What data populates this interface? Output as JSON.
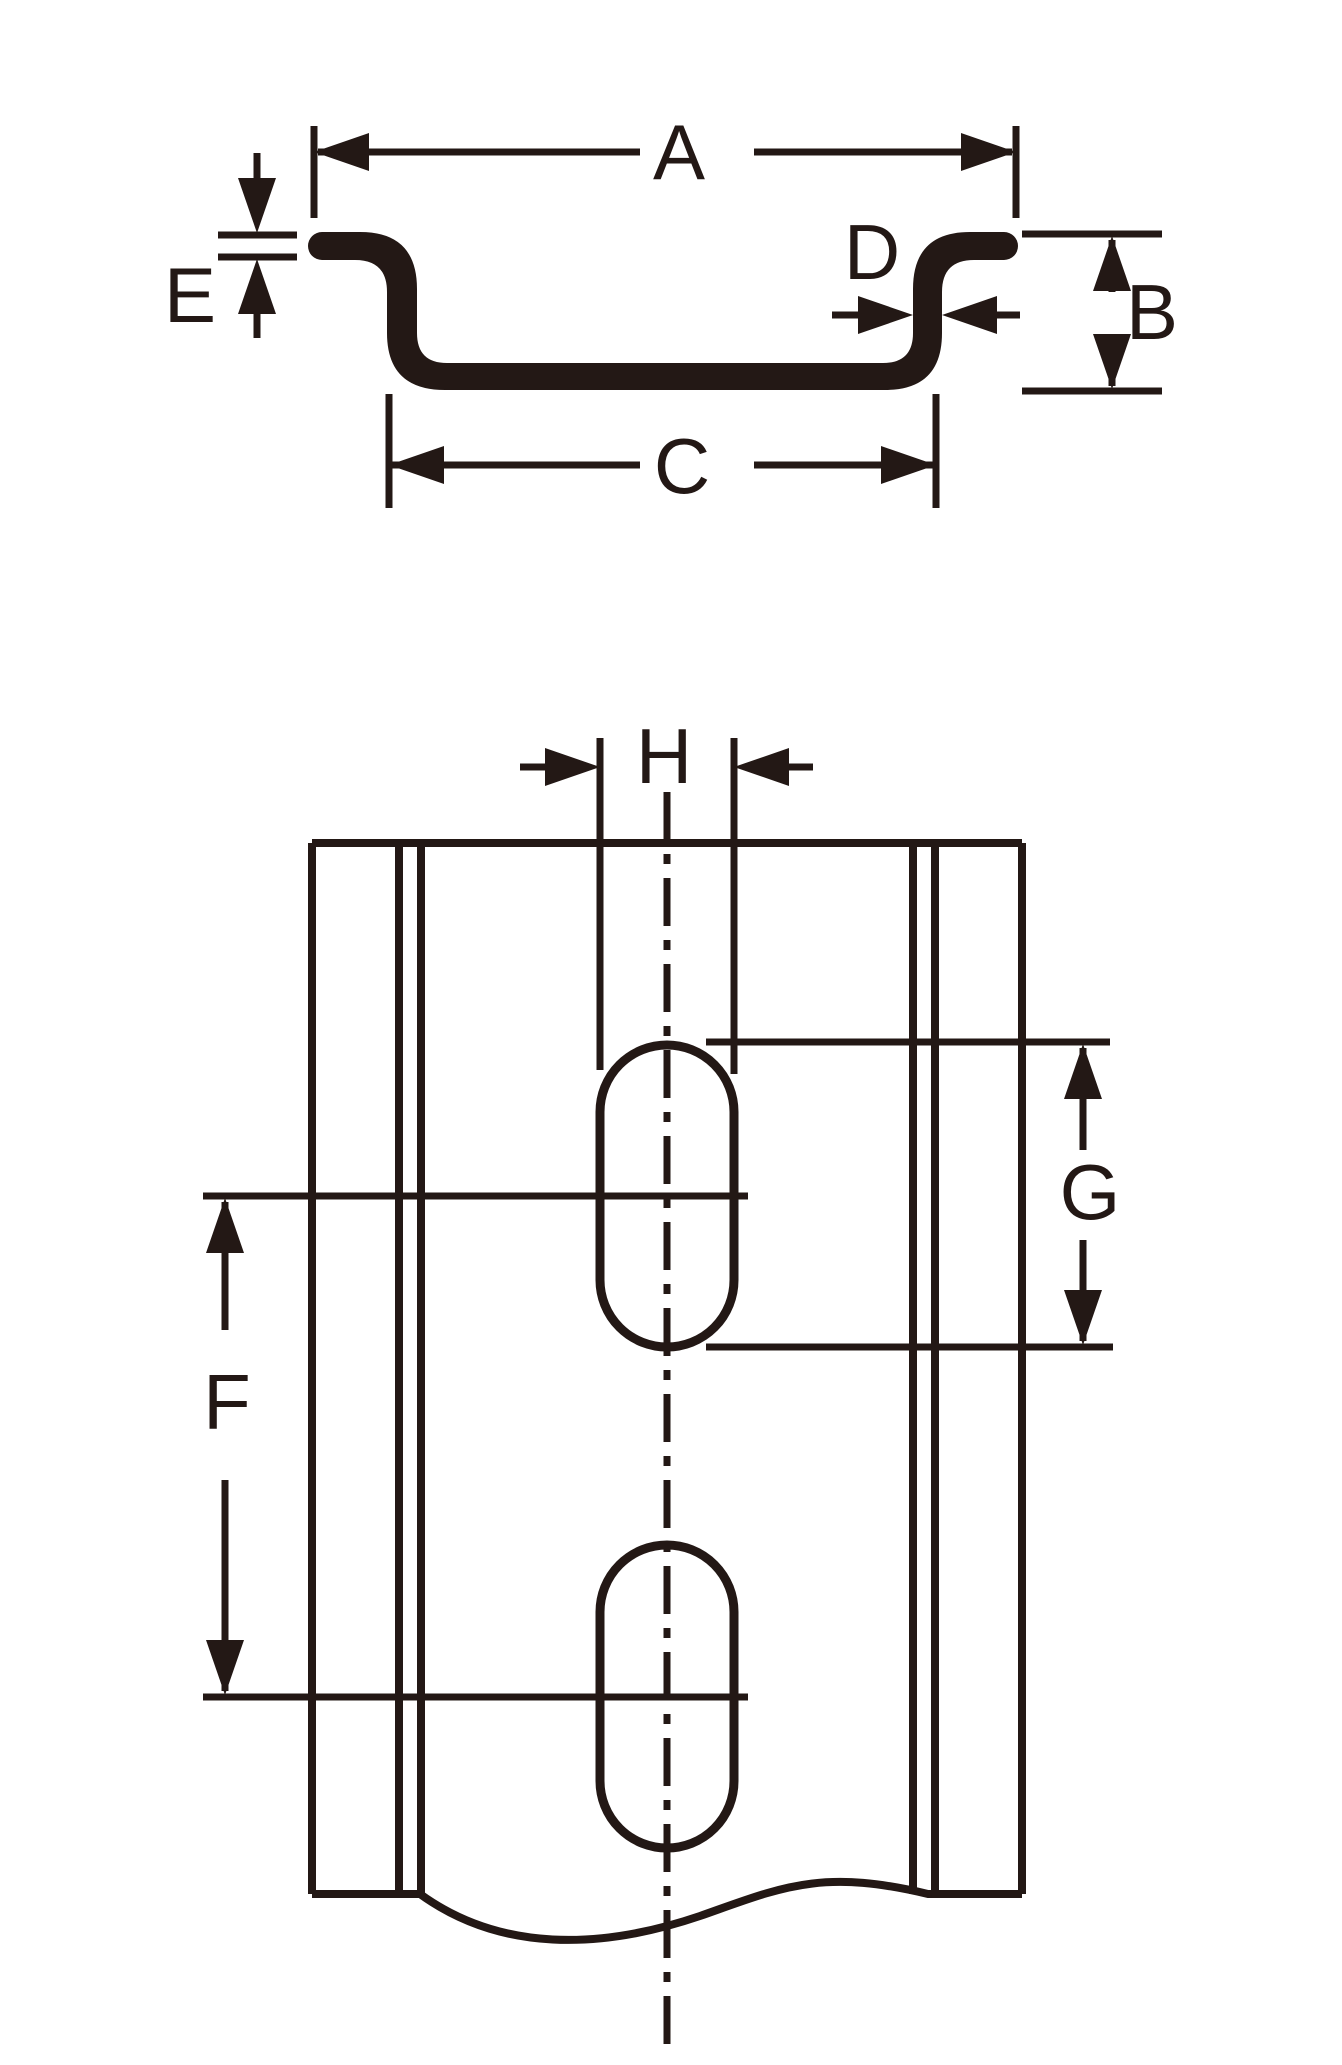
{
  "ink_color": "#231815",
  "background_color": "#ffffff",
  "drawing": {
    "type": "technical-dimension-drawing",
    "subject": "slotted DIN mounting rail",
    "views": {
      "cross_section": {
        "name": "hat-profile cross-section view",
        "dimension_labels": {
          "A": "A",
          "B": "B",
          "C": "C",
          "D": "D",
          "E": "E"
        },
        "dimension_meaning_hint": {
          "A": "overall width across top flanges",
          "B": "overall height",
          "C": "channel width at base",
          "D": "web thickness",
          "E": "material thickness"
        }
      },
      "front_view": {
        "name": "front view with mounting slots",
        "dimension_labels": {
          "F": "F",
          "G": "G",
          "H": "H"
        },
        "dimension_meaning_hint": {
          "F": "slot pitch center-to-center",
          "G": "slot length",
          "H": "slot width"
        }
      }
    }
  }
}
